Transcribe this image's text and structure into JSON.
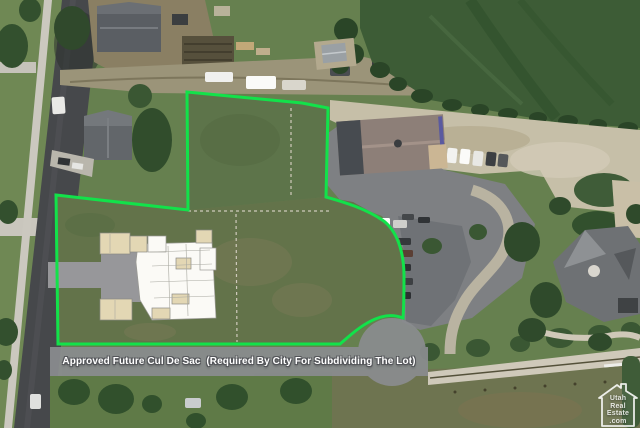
{
  "annotation": {
    "caption": "Approved Future Cul De Sac  (Required By City For Subdividing The Lot)"
  },
  "watermark": {
    "icon": "house-outline-icon",
    "lines": [
      "Utah",
      "Real",
      "Estate",
      ".com"
    ]
  },
  "colors": {
    "boundary_green": "#12e24a",
    "overlay_gray": "#8a8c8f",
    "caption_text": "#ffffff",
    "watermark_white": "#ffffff"
  }
}
